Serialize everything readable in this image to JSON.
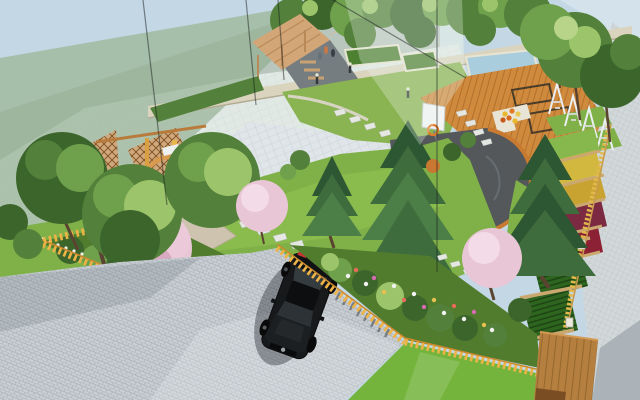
{
  "meta": {
    "title": "Residential courtyard landscape design - aerial 3D render",
    "type": "photorealistic 3D rendering, no visible text or UI chrome",
    "objects": [
      "sky",
      "translucent glass building volume (top-left)",
      "grey boundary wall",
      "cream scalloped garden wall with tree row",
      "light paved plaza",
      "timber lean-to pergola with steps and figures",
      "raised hedge planters",
      "blue water feature",
      "red-soil planter bed",
      "orange timber deck with sunken seating pits",
      "white A-frame swing sets",
      "basketball backboard with hoop",
      "dark half-round sport court with orange curb",
      "stepping-stone paths",
      "sloped lawn",
      "spruce/conifer trees",
      "leafy courtyard trees",
      "pink cherry-blossom trees",
      "yellow picket fences",
      "fenced shrub and flower beds",
      "terraced flower plots (yellow, maroon)",
      "row-planted vegetable plots",
      "grey paver driveway with black sedan",
      "picket-fence shadows on paving",
      "small timber platform deck",
      "perimeter tile pavement outside wall"
    ]
  },
  "palette": {
    "sky": "#c3d7e4",
    "wallGray": "#9daba6",
    "veil": "rgba(158,185,155,0.78)",
    "film": "rgba(228,240,226,0.40)",
    "filmTop": "rgba(236,244,237,0.30)",
    "plaza": "#dfe5e8",
    "plazaDot": "#c9d0d4",
    "creamWall": "#dad4be",
    "creamWallShadow": "#b3ac94",
    "patio": "#767d80",
    "pergolaWood": "#d3a678",
    "pergolaBeam": "#b98a58",
    "hedge": "#4e8032",
    "hedgeTrim": "#e8e4d2",
    "water": "#a9cddd",
    "soil": "#9c5f42",
    "lawnTop": "#8ab452",
    "lawn": "#7fb148",
    "lawnBright": "#8fc152",
    "lawnLow": "#74b43c",
    "deck": "#d08a3e",
    "deckLine": "#b2702a",
    "court": "#54585b",
    "curb": "#c87a30",
    "stone": "#e5e7e3",
    "road": "#c8ced3",
    "roadJoint": "#aab2b8",
    "fence": "#eeb347",
    "fenceDark": "#c98a2e",
    "carBody": "#17191b",
    "carGlass": "#353c40",
    "carShadow": "rgba(25,30,40,0.38)",
    "tailLight": "#c53430",
    "foliageDark": "#3c652c",
    "foliageMid": "#53803a",
    "foliageLight": "#6fa04c",
    "foliagePale": "#9cc46a",
    "coniferDark": "#2d5632",
    "conifer": "#3e6c3d",
    "coniferLight": "#4c7e47",
    "blossom": "#e9c6d6",
    "blossomLight": "#f3dce7",
    "trunk": "#5a4330",
    "bedGreen": "#517c2e",
    "plotGrass": "#86b84e",
    "plotYellow": "#d2b83e",
    "plotGold": "#c9a332",
    "plotMaroon": "#7c2a42",
    "plotWine": "#8c2136",
    "plotVeg": "#2e651f",
    "plotRow": "#1d4614",
    "dividerTan": "#caa870",
    "wallTanFence": "#e0b84c",
    "deckSmall": "#b5803f",
    "deckSmallLine": "#96682e",
    "pavement": "#d2d8d9",
    "pavementJoint": "#bcc5c7",
    "pavementShadow": "#a6afb4",
    "backboard": "#f3f5f5",
    "rim": "#e07a28",
    "white": "#eef0ee",
    "swing": "#ecefef",
    "frameLine": "rgba(25,30,30,0.5)"
  }
}
